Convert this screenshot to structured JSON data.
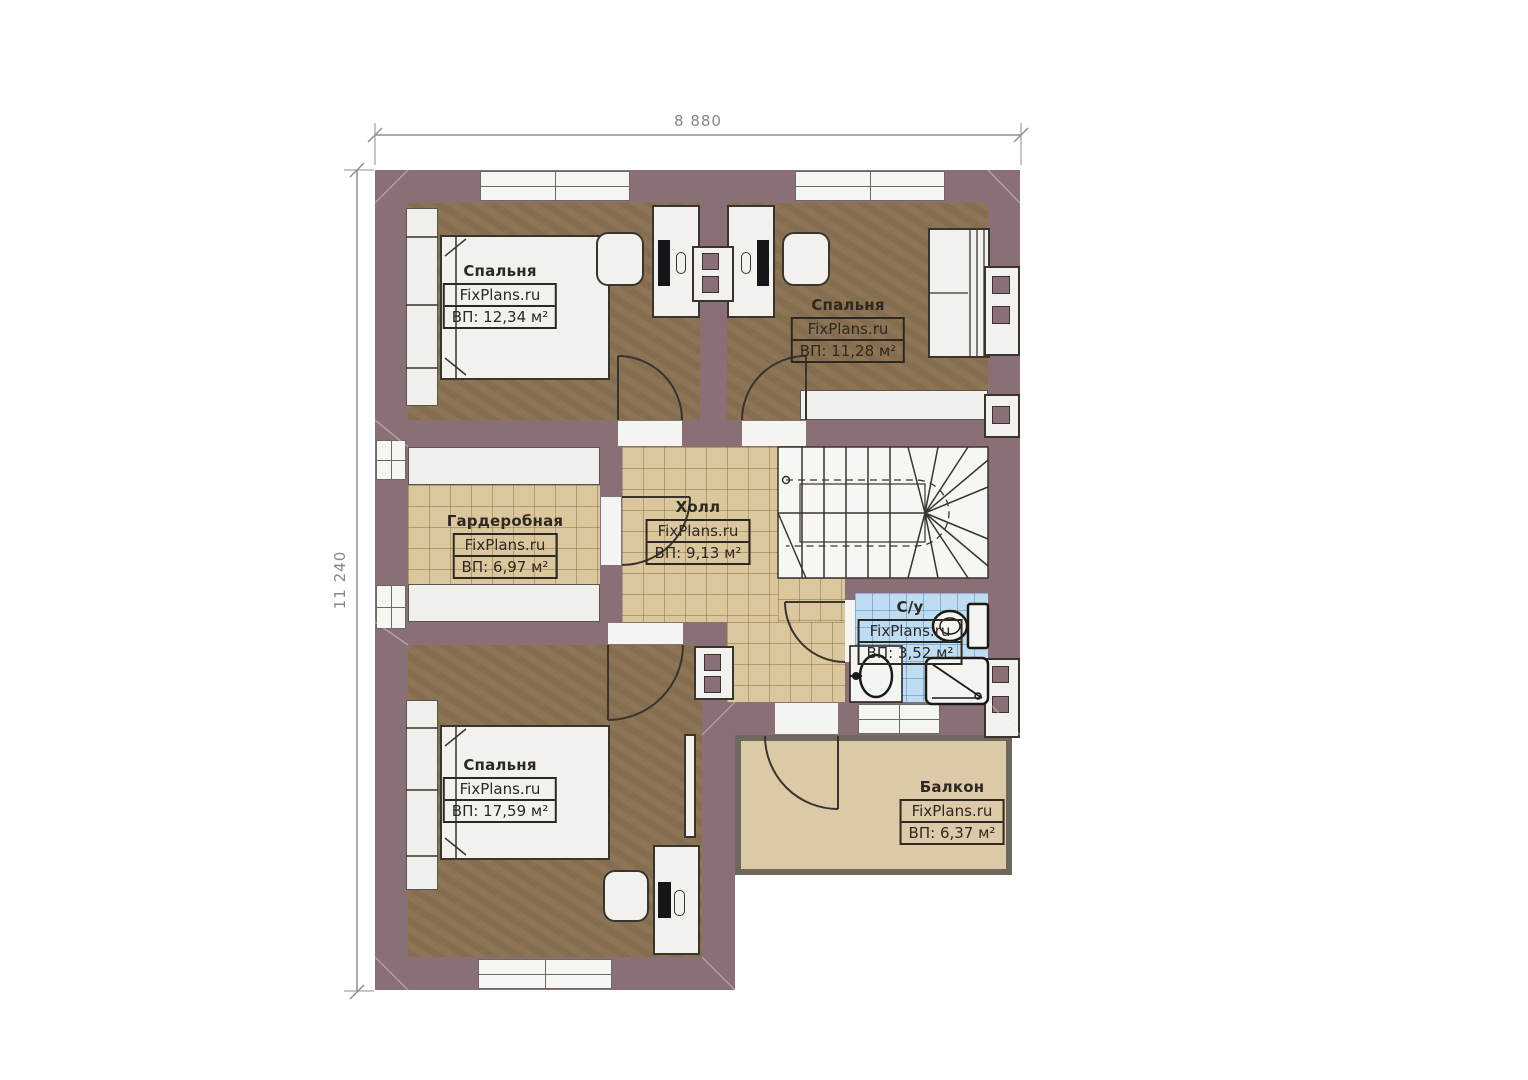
{
  "watermark": "FixPlans.ru",
  "dimensions": {
    "top": "8 880",
    "left": "11 240"
  },
  "rooms": {
    "bedroom1": {
      "name": "Спальня",
      "area": "ВП: 12,34 м²"
    },
    "bedroom2": {
      "name": "Спальня",
      "area": "ВП: 11,28 м²"
    },
    "wardrobe": {
      "name": "Гардеробная",
      "area": "ВП: 6,97 м²"
    },
    "hall": {
      "name": "Холл",
      "area": "ВП: 9,13 м²"
    },
    "bathroom": {
      "name": "С/у",
      "area": "ВП: 3,52 м²"
    },
    "bedroom3": {
      "name": "Спальня",
      "area": "ВП: 17,59 м²"
    },
    "balcony": {
      "name": "Балкон",
      "area": "ВП: 6,37 м²"
    }
  },
  "colors": {
    "wall": "#8b6f76",
    "bedroom_floor": "#8c7454",
    "tile_floor": "#dbc79d",
    "bathroom_tile": "#bedcf2",
    "balcony_floor": "#dbc9a7",
    "furniture": "#f2f1ee",
    "outline": "#3a342e"
  }
}
